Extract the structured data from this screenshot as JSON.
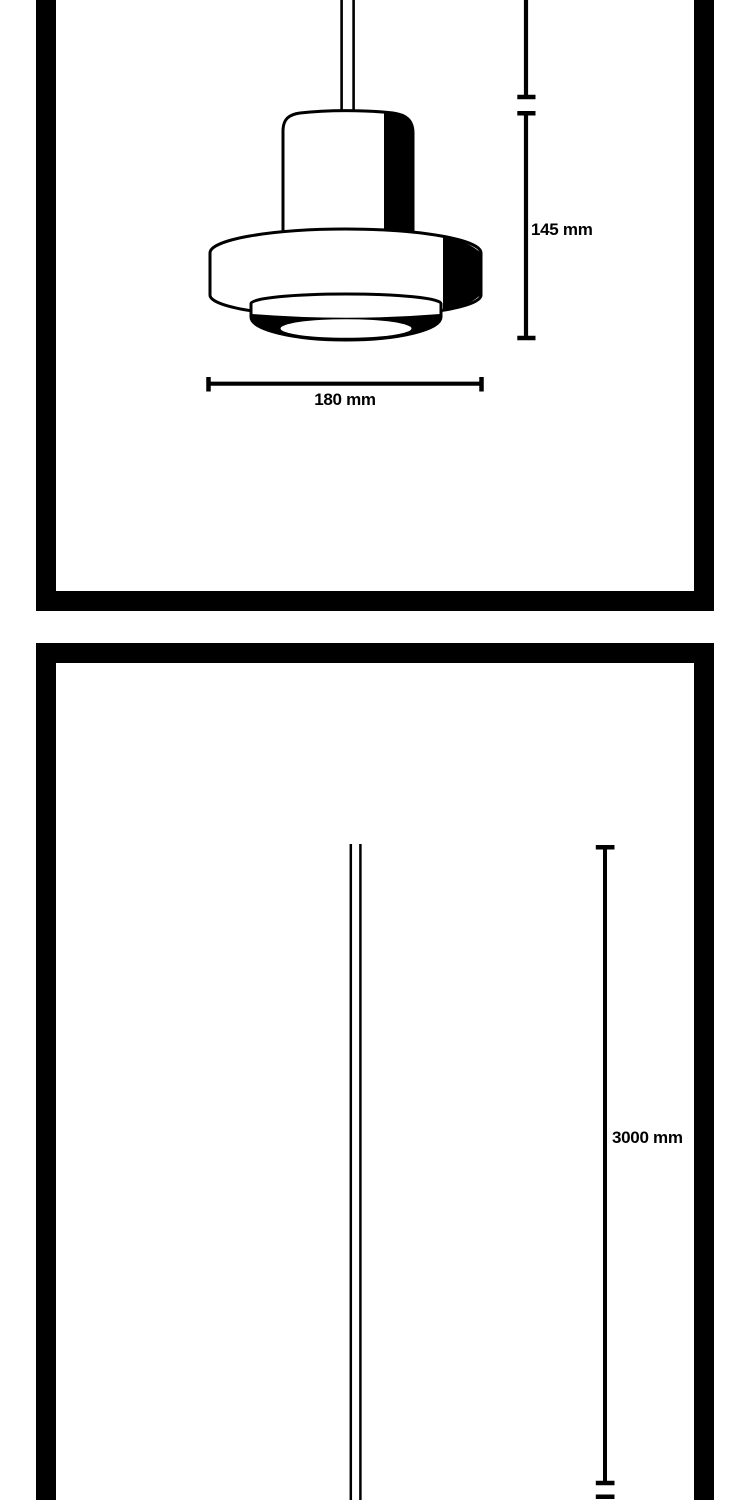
{
  "colors": {
    "ink": "#000000",
    "paper": "#ffffff"
  },
  "head_panel": {
    "height_dimension": "145 mm",
    "width_dimension": "180 mm"
  },
  "cable_panel": {
    "length_dimension": "3000 mm"
  }
}
